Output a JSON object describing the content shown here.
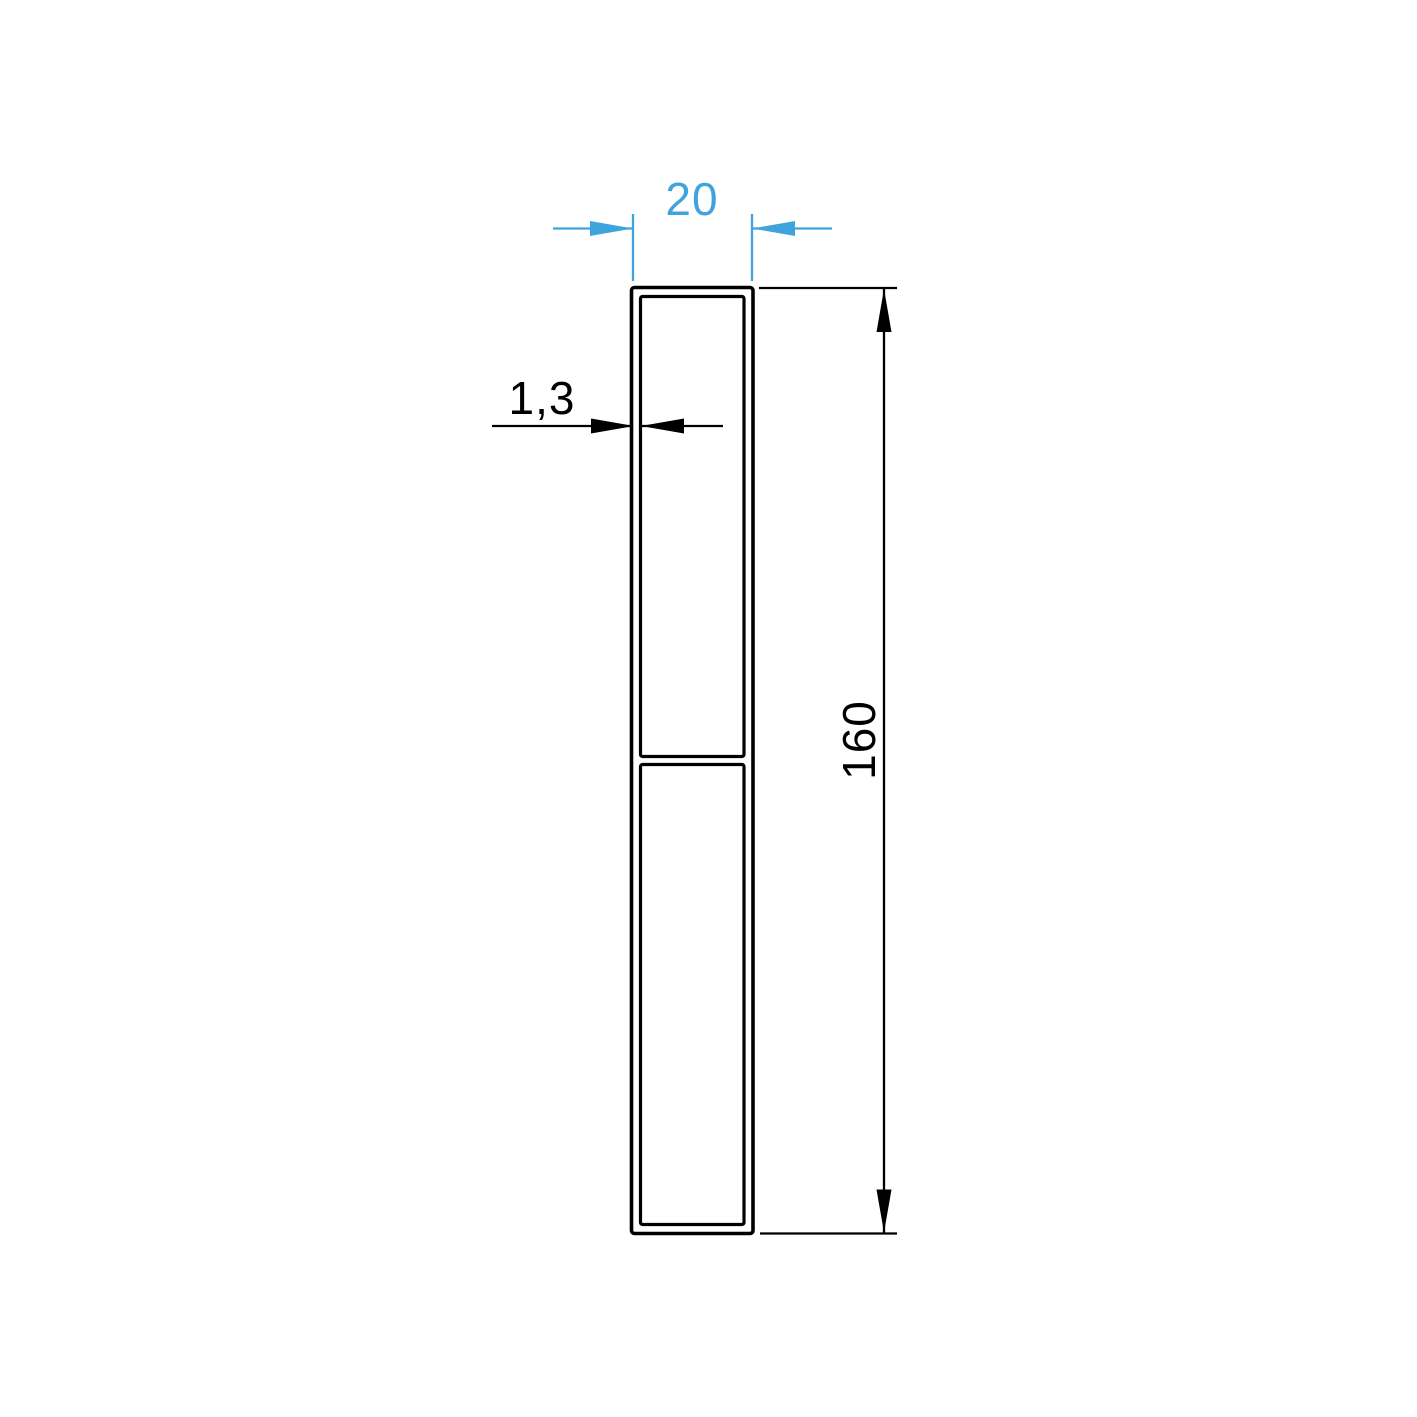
{
  "drawing": {
    "labels": {
      "width": "20",
      "wall_thickness": "1,3",
      "height": "160"
    },
    "colors": {
      "accent_blue": "#3fa3dd",
      "line_black": "#000000",
      "background": "#ffffff"
    }
  }
}
